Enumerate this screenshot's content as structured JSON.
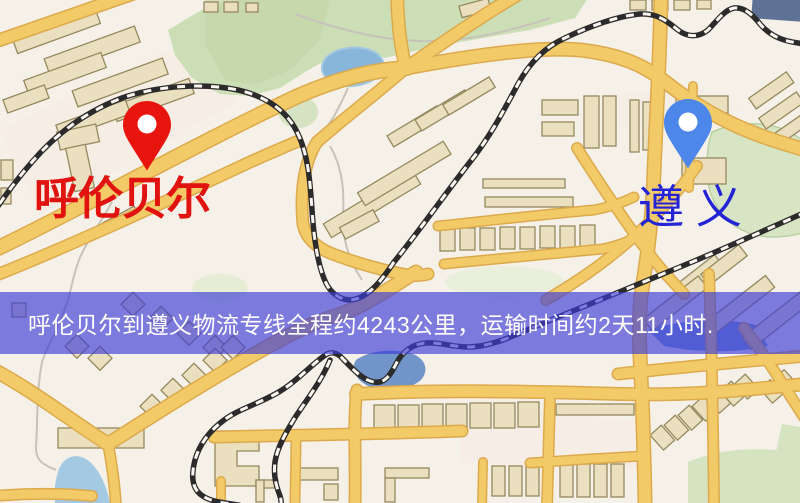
{
  "banner": {
    "text": "呼伦贝尔到遵义物流专线全程约4243公里，运输时间约2天11小时.",
    "background_color": "rgba(60,60,215,0.66)",
    "text_color": "#ffffff"
  },
  "markers": {
    "origin": {
      "label": "呼伦贝尔",
      "pin_color": "#e8150e",
      "label_color": "#e01310"
    },
    "destination": {
      "label": "遵义",
      "pin_color": "#4d87ea",
      "label_color": "#2424d6"
    }
  },
  "route": {
    "from": "呼伦贝尔",
    "to": "遵义",
    "distance_text": "约4243公里",
    "duration_text": "约2天11小时"
  },
  "map_palette": {
    "background": "#f6f1e8",
    "road": "#f3ca68",
    "road_casing": "#dcaa4c",
    "park": "#ccdeb5",
    "water": "#87b6da",
    "railway": "#2b2b2b",
    "building": "#eadfbe"
  }
}
